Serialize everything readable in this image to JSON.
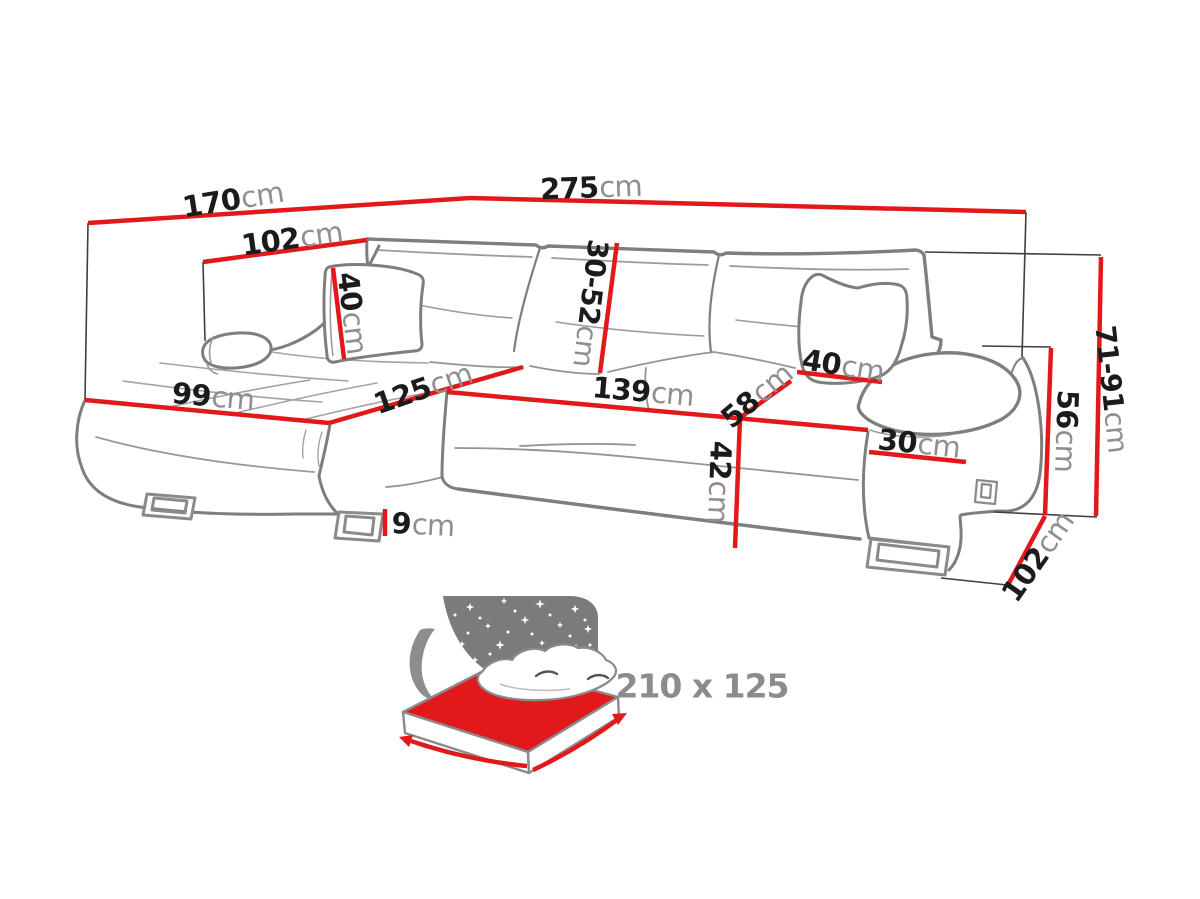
{
  "title": "Corner sofa bed dimensions diagram",
  "unit_default": "cm",
  "colors": {
    "dimension_red": "#e2191b",
    "outline_gray": "#7e7e7e",
    "number_black": "#1b1b1b",
    "unit_gray": "#8f8f8f",
    "icon_gray": "#7b7b7b"
  },
  "dimensions": [
    {
      "id": "chaise-side-total-depth",
      "value": "170",
      "unit": "cm"
    },
    {
      "id": "chaise-inner-depth",
      "value": "102",
      "unit": "cm"
    },
    {
      "id": "total-width",
      "value": "275",
      "unit": "cm"
    },
    {
      "id": "left-cushion-size",
      "value": "40",
      "unit": "cm"
    },
    {
      "id": "backrest-height-range",
      "value": "30-52",
      "unit": "cm"
    },
    {
      "id": "chaise-front-width",
      "value": "99",
      "unit": "cm"
    },
    {
      "id": "chaise-length",
      "value": "125",
      "unit": "cm"
    },
    {
      "id": "seat-width",
      "value": "139",
      "unit": "cm"
    },
    {
      "id": "seat-depth",
      "value": "58",
      "unit": "cm"
    },
    {
      "id": "right-cushion-size",
      "value": "40",
      "unit": "cm"
    },
    {
      "id": "armrest-width",
      "value": "30",
      "unit": "cm"
    },
    {
      "id": "seat-height",
      "value": "42",
      "unit": "cm"
    },
    {
      "id": "leg-height",
      "value": "9",
      "unit": "cm"
    },
    {
      "id": "overall-height-range",
      "value": "71-91",
      "unit": "cm"
    },
    {
      "id": "armrest-height",
      "value": "56",
      "unit": "cm"
    },
    {
      "id": "side-depth",
      "value": "102",
      "unit": "cm"
    }
  ],
  "sleeping_area": {
    "label": "210 x 125"
  }
}
